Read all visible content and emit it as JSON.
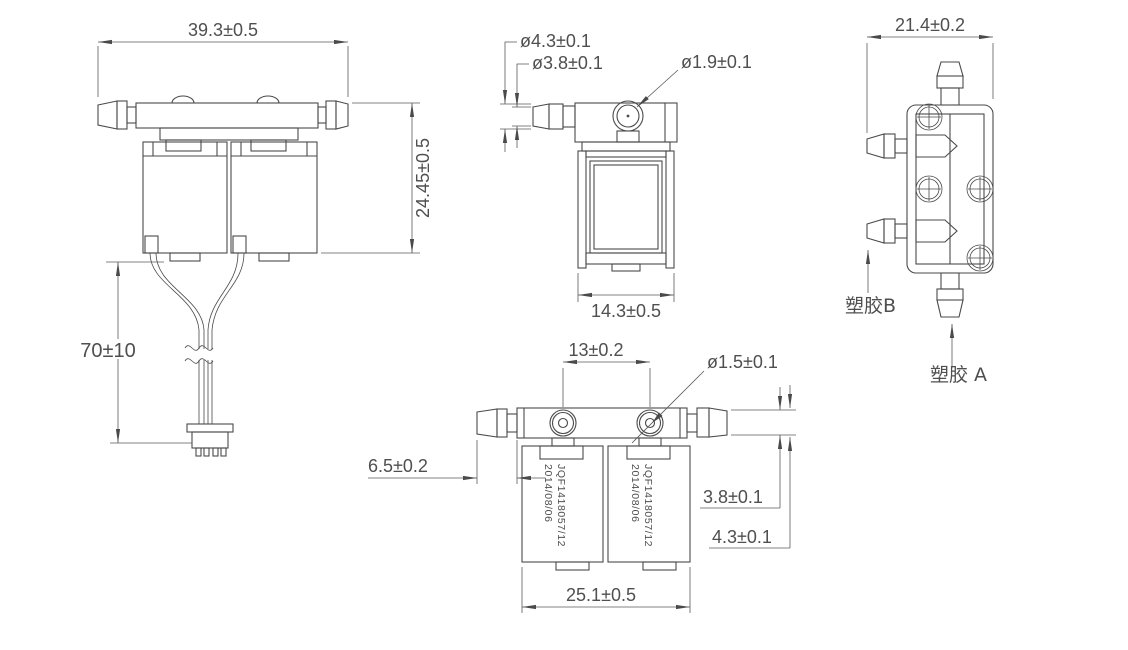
{
  "drawing": {
    "type": "engineering-cad-drawing",
    "part": "dual solenoid valve manifold",
    "background": "#ffffff",
    "line_color": "#4a4a4a",
    "views": {
      "front": {
        "name": "front-view",
        "dims": {
          "overall_width": "39.3±0.5",
          "overall_height": "24.45±0.5",
          "wire_length": "70±10"
        }
      },
      "side": {
        "name": "side-view",
        "dims": {
          "barb_od": "ø4.3±0.1",
          "barb_tip_od": "ø3.8±0.1",
          "port_hole": "ø1.9±0.1",
          "body_depth": "14.3±0.5"
        }
      },
      "end": {
        "name": "end-view",
        "dims": {
          "overall_depth": "21.4±0.2"
        },
        "labels": {
          "plastic_b": "塑胶B",
          "plastic_a": "塑胶 A"
        }
      },
      "bottom": {
        "name": "bottom-view",
        "dims": {
          "port_spacing": "13±0.2",
          "port_hole": "ø1.5±0.1",
          "barb_length": "6.5±0.2",
          "barb_tip_od": "3.8±0.1",
          "barb_od": "4.3±0.1",
          "body_width": "25.1±0.5"
        },
        "marking_line1": "JQF1418057/12",
        "marking_line2": "2014/08/06"
      }
    }
  }
}
